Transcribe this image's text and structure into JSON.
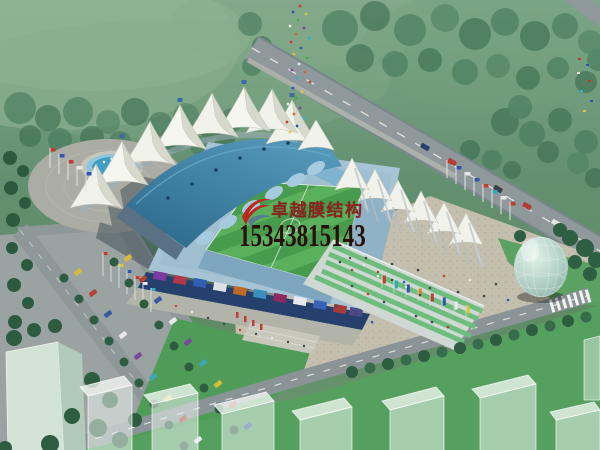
{
  "watermark": {
    "company_name": "卓越膜结构",
    "phone_number": "15343815143",
    "logo_icon": "red-swoosh-bird-logo",
    "company_color": "#8a231d",
    "phone_color": "#2a0e0a"
  },
  "scene": {
    "type": "aerial architectural rendering",
    "subject": "stadium with white tensile membrane canopy roofs",
    "elements": [
      "forest and lawns",
      "diagonal perimeter road with cars",
      "south road with zebra crosswalk",
      "circular fountain plaza",
      "tree-lined parking lot with parked cars",
      "flag poles with colored flags",
      "striped football pitch",
      "blue pitched grandstand roof",
      "row of white membrane tent peaks",
      "steel mast supports",
      "green terraced steps",
      "billboard facade",
      "pedestrian crowds",
      "glass dome pavilion",
      "translucent planned buildings"
    ],
    "palette": {
      "forest_green": "#5f8c68",
      "lawn_green": "#4f9c58",
      "field_green": "#469b4d",
      "field_stripe_green": "#5ab05c",
      "road_gray": "#8f999c",
      "plaza_beige": "#c4bfae",
      "roof_blue": "#2e6d8f",
      "stand_blue": "#a6c4d5",
      "membrane_white": "#f1f2ea",
      "fountain_blue": "#3f9ec6",
      "tree_dark_green": "#2d5c41",
      "dome_glass": "#bcd8d0"
    }
  }
}
